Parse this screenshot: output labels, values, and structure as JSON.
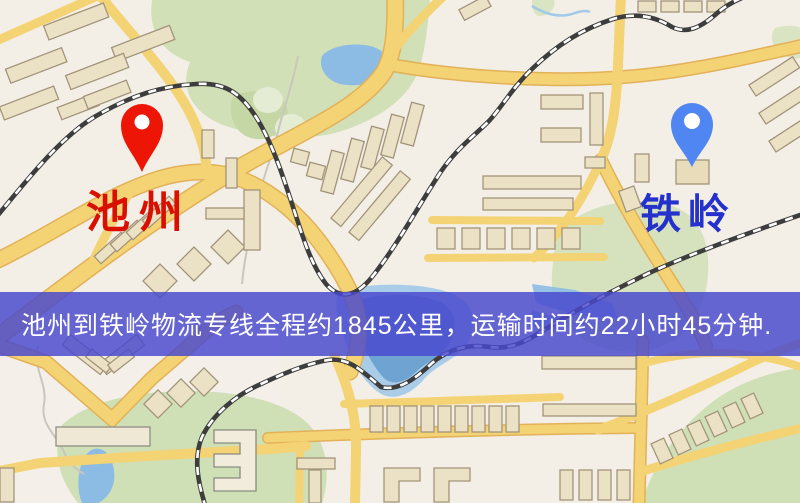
{
  "markers": {
    "origin": {
      "label": "池州",
      "pin_color": "#ed1506",
      "label_color": "#d90f00"
    },
    "destination": {
      "label": "铁岭",
      "pin_color": "#4f86f2",
      "label_color": "#2531cd"
    }
  },
  "banner": {
    "text": "池州到铁岭物流专线全程约1845公里，运输时间约22小时45分钟.",
    "background_color": "#4848ce",
    "text_color": "#ffffff"
  },
  "route": {
    "origin": "池州",
    "destination": "铁岭",
    "distance_text": "约1845公里",
    "duration_text": "约22小时45分钟"
  },
  "map_colors": {
    "background": "#f3efe6",
    "road": "#f4d375",
    "road_casing": "#e2b158",
    "green_area": "#d2e0b8",
    "water": "#8cbbe4",
    "building_fill": "#ebe2c6",
    "building_stroke": "#a2947a",
    "railway": "#3d3d3d"
  }
}
